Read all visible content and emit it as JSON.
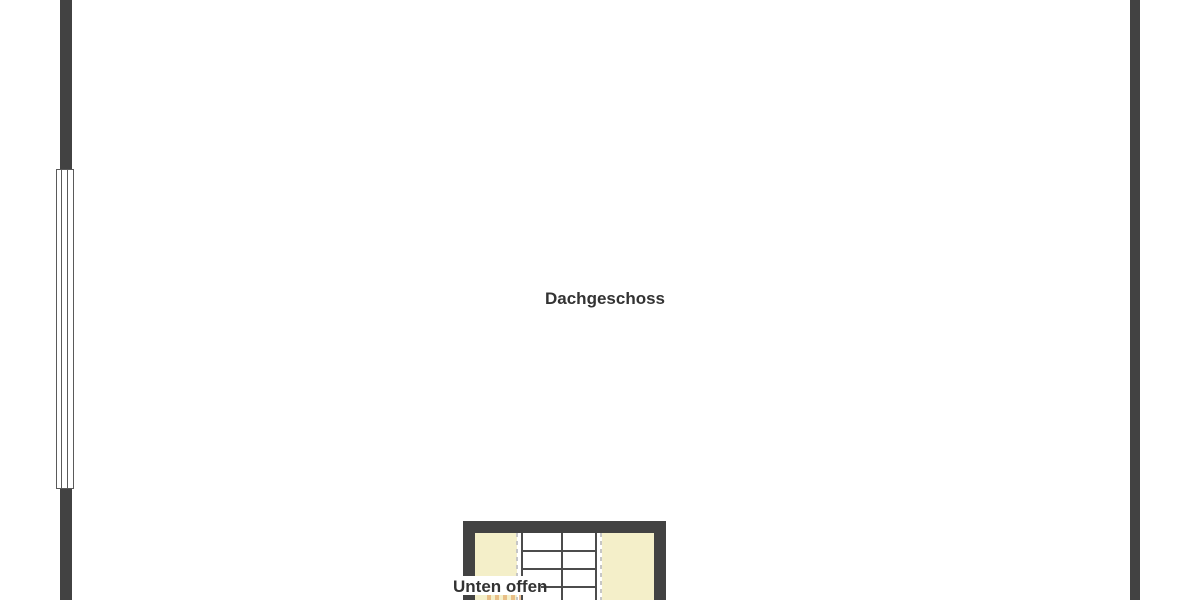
{
  "labels": {
    "room": "Dachgeschoss",
    "stair_note": "Unten offen"
  },
  "plan": {
    "floor": "Dachgeschoss",
    "annotation_meaning": "Unten offen",
    "features": {
      "window": "window-on-left-wall",
      "stairwell": "open-stairwell-bottom-center"
    }
  },
  "colors": {
    "wall": "#424242",
    "stair_line": "#4c4c4c",
    "void_fill": "#f4efc9",
    "dashed_line": "#c6c6c6",
    "text": "#333333",
    "background": "#ffffff",
    "accent_dashes": "#de964e"
  }
}
